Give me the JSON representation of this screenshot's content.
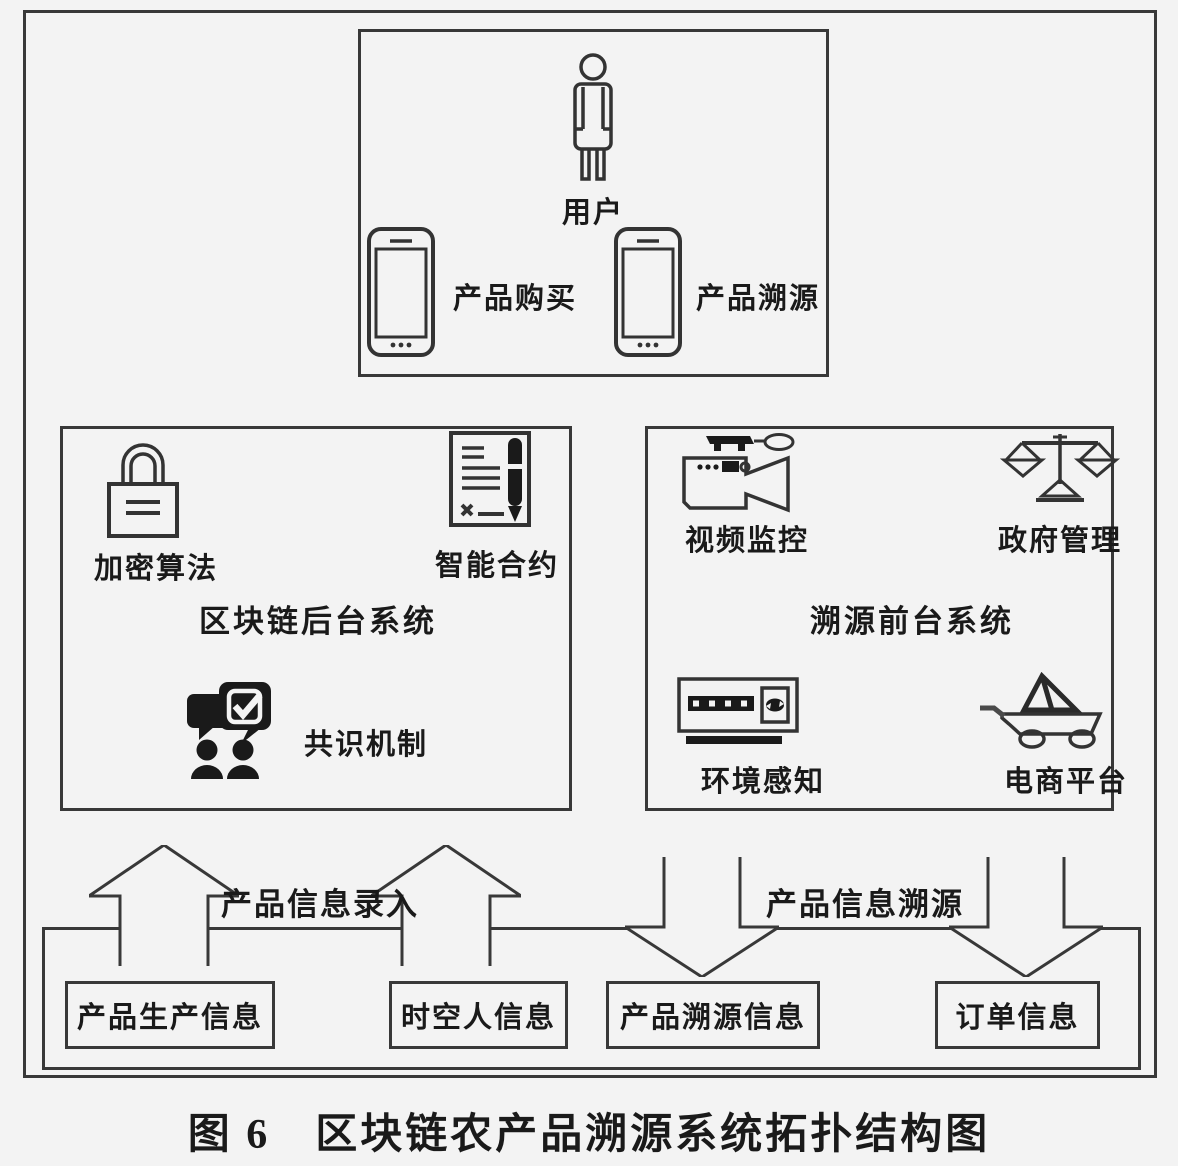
{
  "colors": {
    "line": "#383838",
    "background": "#f3f3f3",
    "icon_fill": "#1a1a1a"
  },
  "caption": "图 6　区块链农产品溯源系统拓扑结构图",
  "user_box": {
    "user_label": "用户",
    "phones": [
      {
        "label": "产品购买"
      },
      {
        "label": "产品溯源"
      }
    ]
  },
  "backend_box": {
    "title": "区块链后台系统",
    "encryption_label": "加密算法",
    "contract_label": "智能合约",
    "consensus_label": "共识机制"
  },
  "frontend_box": {
    "title": "溯源前台系统",
    "video_label": "视频监控",
    "gov_label": "政府管理",
    "env_label": "环境感知",
    "ecommerce_label": "电商平台"
  },
  "flows": {
    "entry_label": "产品信息录入",
    "trace_label": "产品信息溯源"
  },
  "data_boxes": [
    {
      "label": "产品生产信息"
    },
    {
      "label": "时空人信息"
    },
    {
      "label": "产品溯源信息"
    },
    {
      "label": "订单信息"
    }
  ]
}
